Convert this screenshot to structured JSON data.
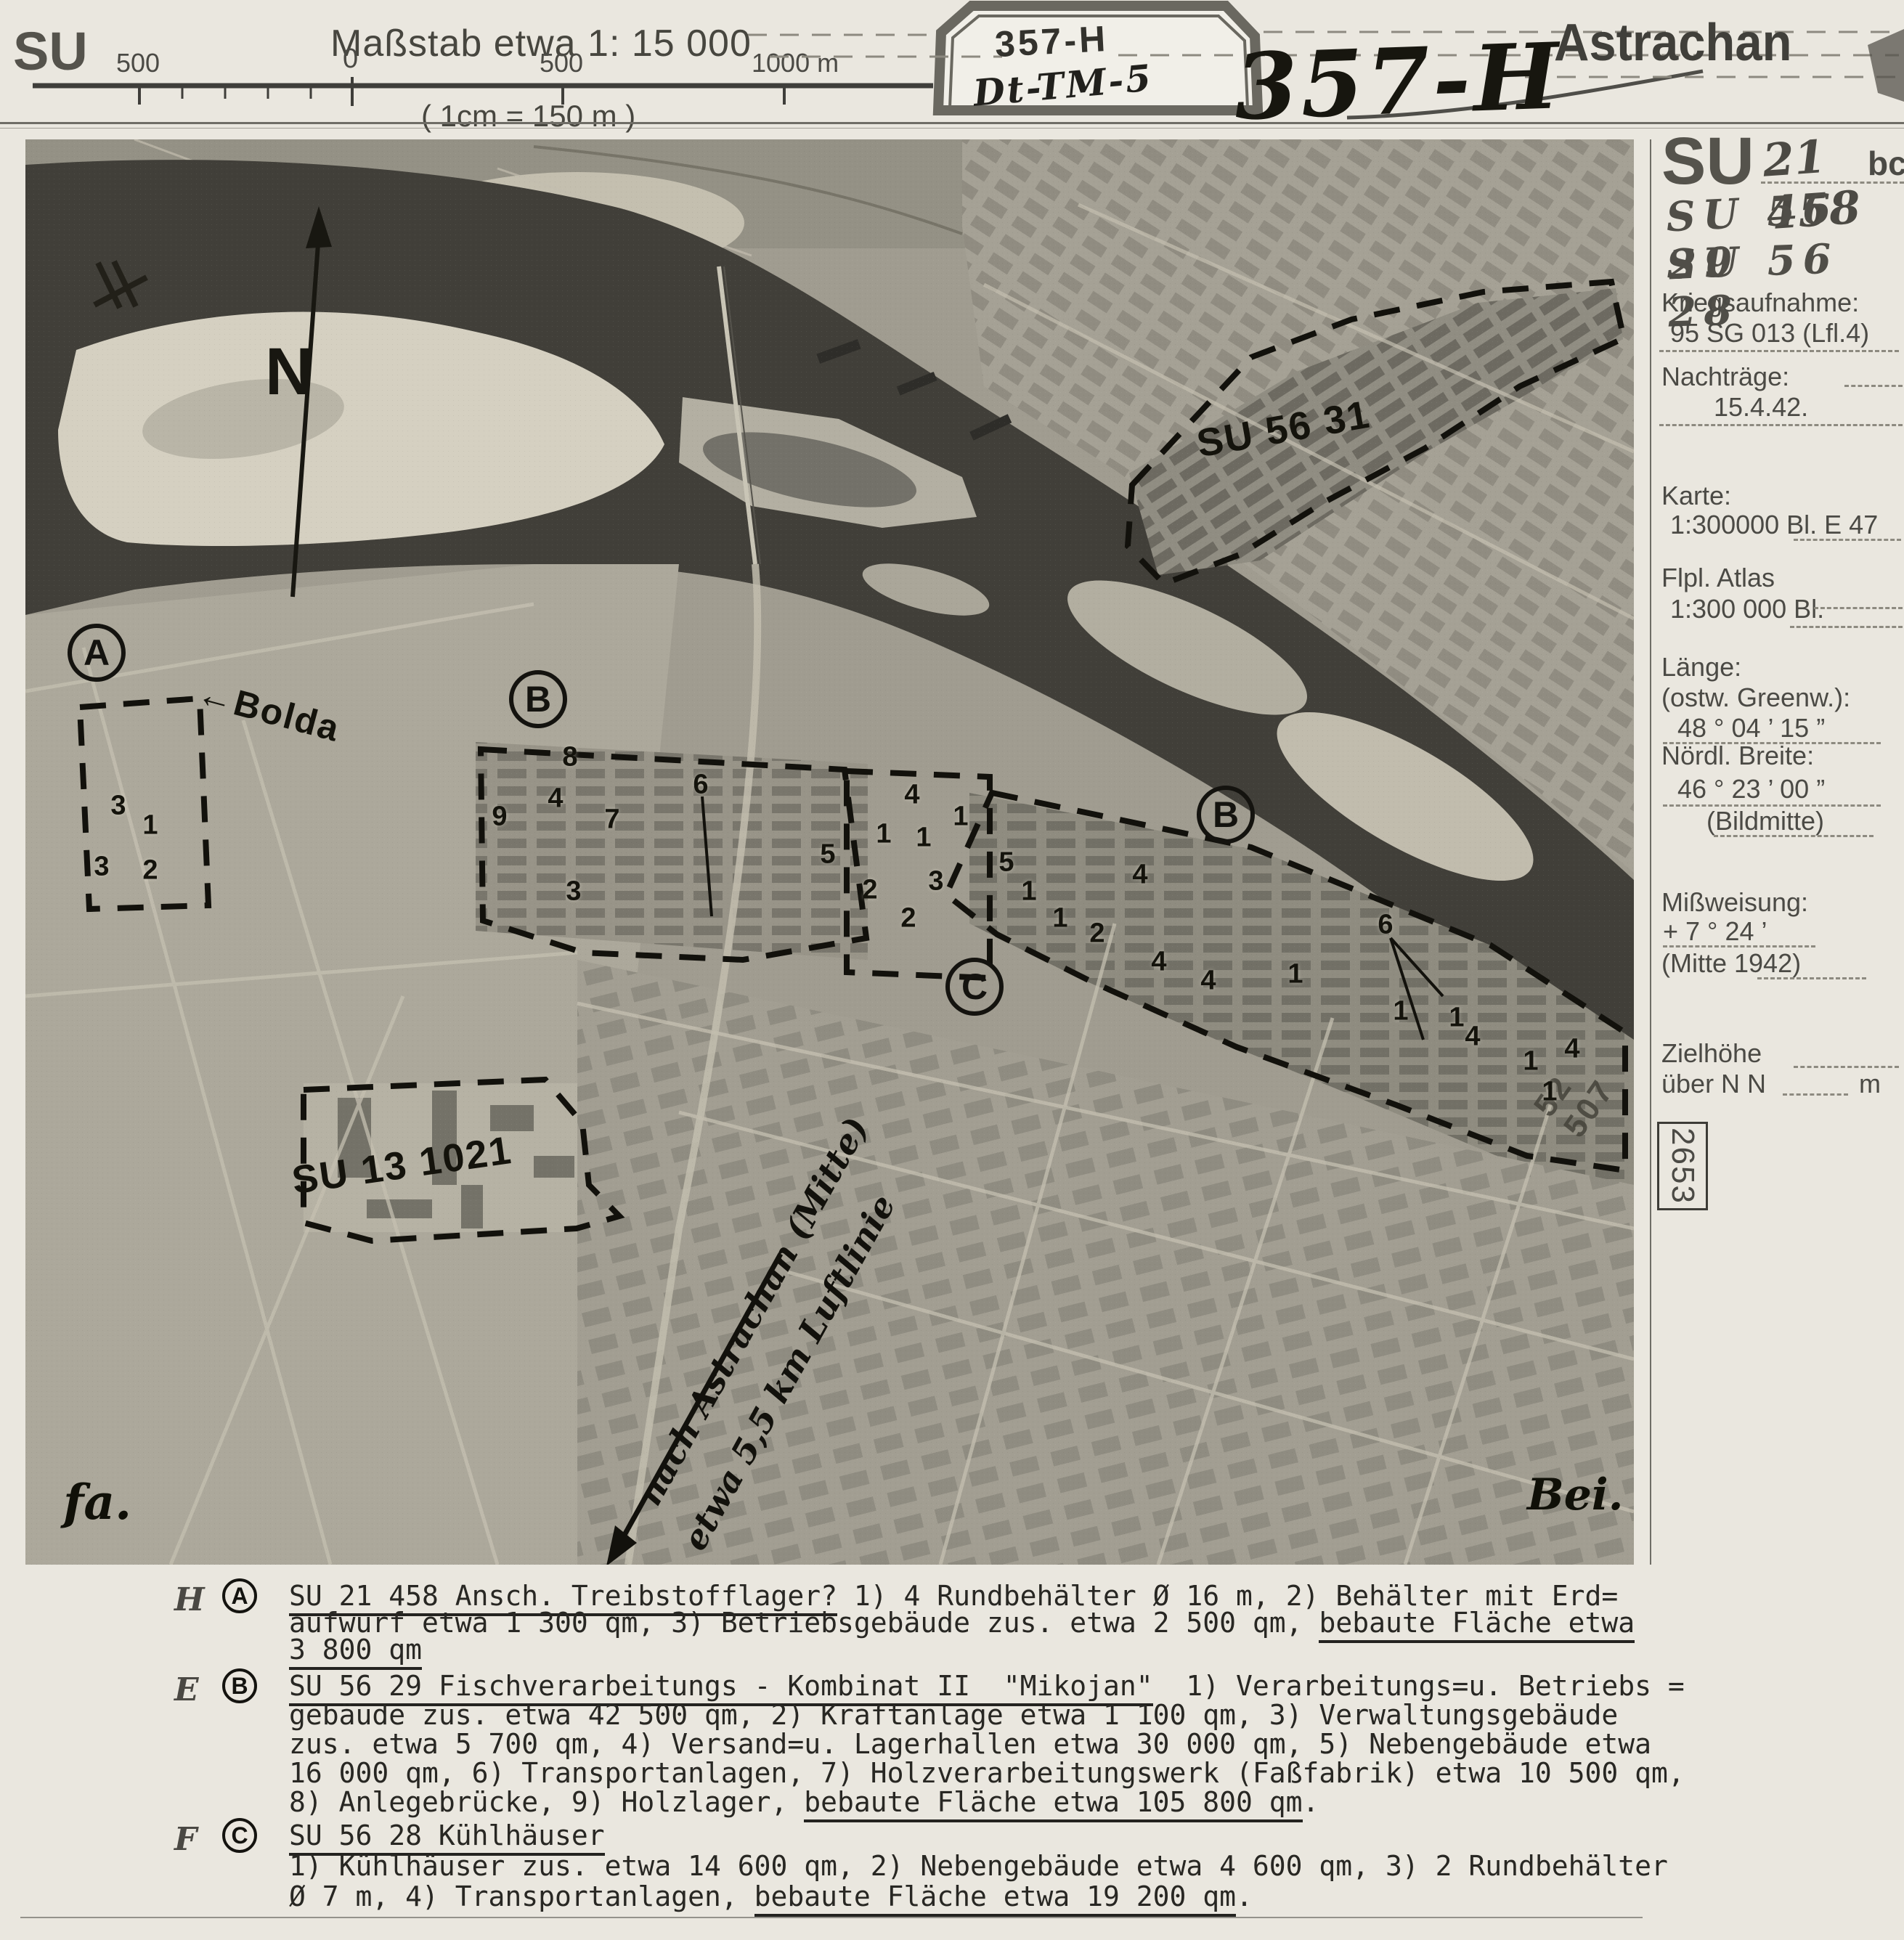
{
  "header": {
    "corner_label": "SU",
    "scale_title": "Maßstab etwa 1: 15 000",
    "scale_sub": "( 1cm = 150 m )",
    "scale_ticks": [
      "500",
      "0",
      "500",
      "1000 m"
    ],
    "stamp_line1": "357-H",
    "stamp_line2": "Dt-TM-5",
    "big_number": "357-H",
    "title": "Astrachan"
  },
  "sidebar": {
    "su_label": "SU",
    "su_value": "21 458",
    "su_suffix": "bc",
    "target2": "SU 56 29",
    "target3": "SU 56 28",
    "kriegsaufnahme_label": "Kriegsaufnahme:",
    "kriegsaufnahme_value": "95 SG 013 (Lfl.4)",
    "nachtraege_label": "Nachträge:",
    "nachtraege_value": "15.4.42.",
    "karte_label": "Karte:",
    "karte_value": "1:300000 Bl. E 47",
    "atlas_label": "Flpl. Atlas",
    "atlas_value": "1:300 000 Bl.",
    "laenge_label": "Länge:",
    "laenge_sub": "(ostw. Greenw.):",
    "laenge_value": "48 ° 04 ’ 15 ”",
    "breite_label": "Nördl. Breite:",
    "breite_value": "46 ° 23 ’ 00 ”",
    "breite_note": "(Bildmitte)",
    "missweisung_label": "Mißweisung:",
    "missweisung_value": "+ 7 ° 24 ’",
    "missweisung_note": "(Mitte 1942)",
    "zielhoehe_label1": "Zielhöhe",
    "zielhoehe_label2": "über N N",
    "zielhoehe_unit": "m",
    "page_number": "2653"
  },
  "photo": {
    "north_label": "N",
    "river_arrow": "←",
    "river_label": "Bolda",
    "area_label_1": "SU 56 31",
    "area_label_2": "SU 13 1021",
    "route_note_line1": "nach Astrachan (Mitte)",
    "route_note_line2": "etwa 5,5 km Luftlinie",
    "stamp_diag": "52 507",
    "sig_left": "fa.",
    "sig_right": "Bei.",
    "circles": [
      [
        "A",
        98,
        707
      ],
      [
        "B",
        706,
        771
      ],
      [
        "B",
        1653,
        930
      ],
      [
        "C",
        1307,
        1167
      ]
    ],
    "numbers": [
      [
        "3",
        128,
        918
      ],
      [
        "1",
        172,
        945
      ],
      [
        "3",
        105,
        1002
      ],
      [
        "2",
        172,
        1007
      ],
      [
        "8",
        750,
        851
      ],
      [
        "4",
        730,
        908
      ],
      [
        "7",
        808,
        937
      ],
      [
        "9",
        653,
        933
      ],
      [
        "6",
        930,
        889
      ],
      [
        "5",
        1105,
        985
      ],
      [
        "3",
        755,
        1036
      ],
      [
        "4",
        1221,
        903
      ],
      [
        "1",
        1182,
        957
      ],
      [
        "1",
        1237,
        962
      ],
      [
        "1",
        1288,
        933
      ],
      [
        "3",
        1254,
        1022
      ],
      [
        "2",
        1163,
        1034
      ],
      [
        "2",
        1216,
        1073
      ],
      [
        "5",
        1351,
        996
      ],
      [
        "1",
        1382,
        1036
      ],
      [
        "1",
        1425,
        1073
      ],
      [
        "4",
        1535,
        1013
      ],
      [
        "2",
        1476,
        1094
      ],
      [
        "4",
        1561,
        1133
      ],
      [
        "4",
        1629,
        1159
      ],
      [
        "1",
        1749,
        1150
      ],
      [
        "6",
        1873,
        1082
      ],
      [
        "1",
        1894,
        1201
      ],
      [
        "1",
        1971,
        1210
      ],
      [
        "4",
        1993,
        1236
      ],
      [
        "1",
        2073,
        1270
      ],
      [
        "4",
        2130,
        1253
      ],
      [
        "1",
        2099,
        1312
      ]
    ]
  },
  "captions": [
    {
      "margin": "H",
      "letter": "A",
      "lines": [
        [
          {
            "t": "SU 21 458 Ansch. Treibstofflager?",
            "u": true
          },
          {
            "t": " 1) 4 Rundbehälter Ø 16 m, 2) Behälter mit Erd="
          }
        ],
        [
          {
            "t": "aufwurf etwa 1 300 qm, 3) Betriebsgebäude zus. etwa 2 500 qm, "
          },
          {
            "t": "bebaute Fläche etwa",
            "u": true
          }
        ],
        [
          {
            "t": "3 800 qm",
            "u": true
          }
        ]
      ]
    },
    {
      "margin": "E",
      "letter": "B",
      "lines": [
        [
          {
            "t": "SU 56 29 Fischverarbeitungs - Kombinat II  \"Mikojan\"",
            "u": true
          },
          {
            "t": "  1) Verarbeitungs=u. Betriebs ="
          }
        ],
        [
          {
            "t": "gebäude zus. etwa 42 500 qm, 2) Kraftanlage etwa 1 100 qm, 3) Verwaltungsgebäude"
          }
        ],
        [
          {
            "t": "zus. etwa 5 700 qm, 4) Versand=u. Lagerhallen etwa 30 000 qm, 5) Nebengebäude etwa"
          }
        ],
        [
          {
            "t": "16 000 qm, 6) Transportanlagen, 7) Holzverarbeitungswerk (Faßfabrik) etwa 10 500 qm,"
          }
        ],
        [
          {
            "t": "8) Anlegebrücke, 9) Holzlager, "
          },
          {
            "t": "bebaute Fläche etwa 105 800 qm",
            "u": true
          },
          {
            "t": "."
          }
        ]
      ]
    },
    {
      "margin": "F",
      "letter": "C",
      "lines": [
        [
          {
            "t": "SU 56 28 Kühlhäuser",
            "u": true
          }
        ],
        [
          {
            "t": "1) Kühlhäuser zus. etwa 14 600 qm, 2) Nebengebäude etwa 4 600 qm, 3) 2 Rundbehälter"
          }
        ],
        [
          {
            "t": "Ø 7 m, 4) Transportanlagen, "
          },
          {
            "t": "bebaute Fläche etwa 19 200 qm",
            "u": true
          },
          {
            "t": "."
          }
        ]
      ]
    }
  ]
}
